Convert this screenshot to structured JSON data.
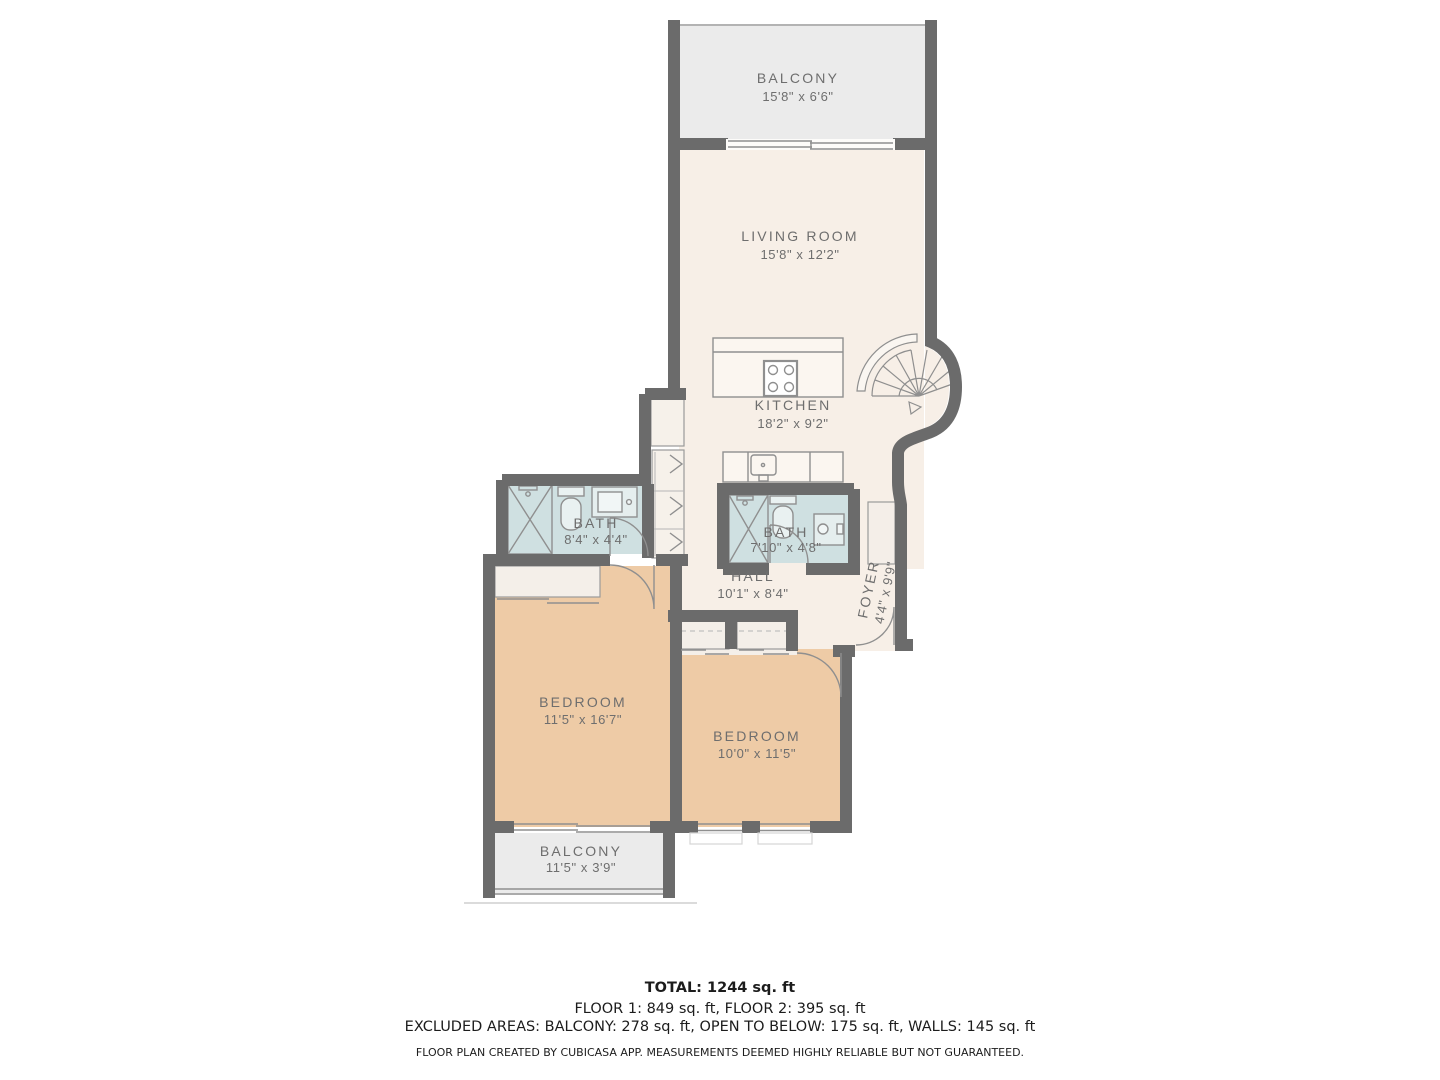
{
  "plan": {
    "app_name": "CubiCasa",
    "rooms": [
      {
        "id": "balcony-top",
        "label": "BALCONY",
        "dims": "15'8\" x 6'6\""
      },
      {
        "id": "living-room",
        "label": "LIVING ROOM",
        "dims": "15'8\" x 12'2\""
      },
      {
        "id": "kitchen",
        "label": "KITCHEN",
        "dims": "18'2\" x 9'2\""
      },
      {
        "id": "bath-left",
        "label": "BATH",
        "dims": "8'4\" x 4'4\""
      },
      {
        "id": "bath-right",
        "label": "BATH",
        "dims": "7'10\" x 4'8\""
      },
      {
        "id": "hall",
        "label": "HALL",
        "dims": "10'1\" x 8'4\""
      },
      {
        "id": "foyer",
        "label": "FOYER",
        "dims": "4'4\" x 9'9\""
      },
      {
        "id": "bedroom-left",
        "label": "BEDROOM",
        "dims": "11'5\" x 16'7\""
      },
      {
        "id": "bedroom-right",
        "label": "BEDROOM",
        "dims": "10'0\" x 11'5\""
      },
      {
        "id": "balcony-bottom",
        "label": "BALCONY",
        "dims": "11'5\" x 3'9\""
      }
    ],
    "summary": {
      "total": "TOTAL: 1244 sq. ft",
      "floors": "FLOOR 1: 849 sq. ft, FLOOR 2: 395 sq. ft",
      "excluded": "EXCLUDED AREAS: BALCONY: 278 sq. ft, OPEN TO BELOW: 175 sq. ft, WALLS: 145 sq. ft",
      "disclaimer": "FLOOR PLAN CREATED BY CUBICASA APP. MEASUREMENTS DEEMED HIGHLY RELIABLE BUT NOT GUARANTEED."
    },
    "colors": {
      "wall": "#6b6b6b",
      "floor_main": "#f7efe7",
      "floor_bedroom": "#eecba6",
      "floor_bath": "#cfe0e1",
      "floor_balcony": "#ebebeb",
      "fixture_line": "#8f8f8f",
      "label_text": "#6e6e6e",
      "summary_text": "#1c1c1c"
    }
  }
}
